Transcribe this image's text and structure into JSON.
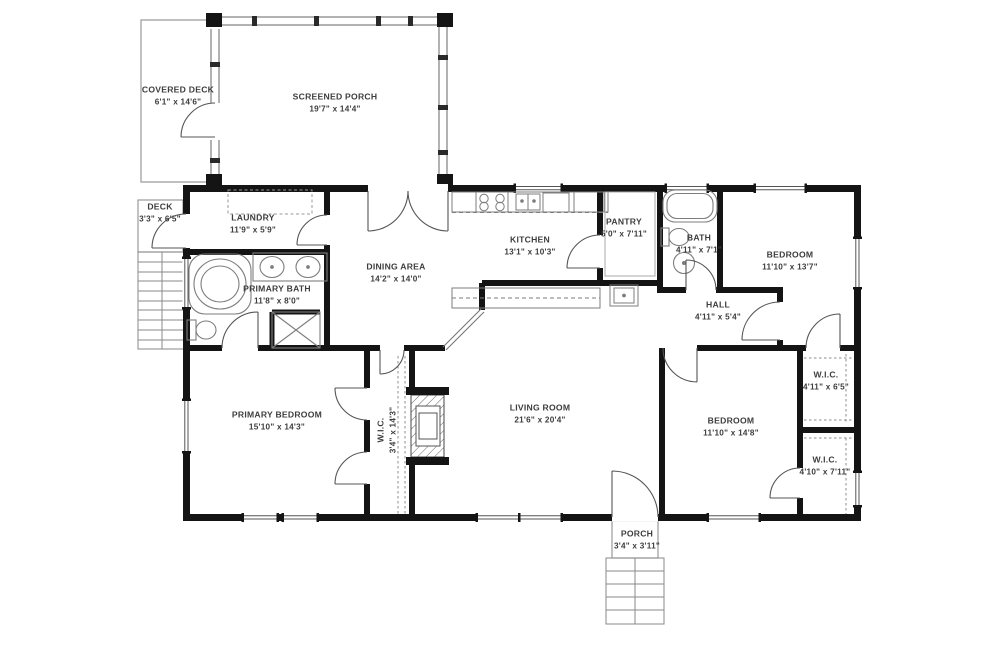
{
  "plan_type": "2D residential floor plan",
  "colors": {
    "walls": "#141414",
    "fixtures": "#777777",
    "labels": "#3d3d3d",
    "background": "#ffffff"
  },
  "rooms": [
    {
      "name": "COVERED DECK",
      "dims": "6'1\" x 14'6\""
    },
    {
      "name": "SCREENED PORCH",
      "dims": "19'7\" x 14'4\""
    },
    {
      "name": "DECK",
      "dims": "3'3\" x 6'5\""
    },
    {
      "name": "LAUNDRY",
      "dims": "11'9\" x 5'9\""
    },
    {
      "name": "PRIMARY BATH",
      "dims": "11'8\" x 8'0\""
    },
    {
      "name": "DINING AREA",
      "dims": "14'2\" x 14'0\""
    },
    {
      "name": "KITCHEN",
      "dims": "13'1\" x 10'3\""
    },
    {
      "name": "PANTRY",
      "dims": "5'0\" x 7'11\""
    },
    {
      "name": "BATH",
      "dims": "4'11\" x 7'1\""
    },
    {
      "name": "BEDROOM",
      "dims": "11'10\" x 13'7\""
    },
    {
      "name": "HALL",
      "dims": "4'11\" x 5'4\""
    },
    {
      "name": "PRIMARY BEDROOM",
      "dims": "15'10\" x 14'3\""
    },
    {
      "name": "W.I.C.",
      "dims": "3'4\" x 14'3\""
    },
    {
      "name": "LIVING ROOM",
      "dims": "21'6\" x 20'4\""
    },
    {
      "name": "BEDROOM",
      "dims": "11'10\" x 14'8\""
    },
    {
      "name": "W.I.C.",
      "dims": "4'11\" x 6'5\""
    },
    {
      "name": "W.I.C.",
      "dims": "4'10\" x 7'11\""
    },
    {
      "name": "PORCH",
      "dims": "3'4\" x 3'11\""
    }
  ],
  "fixtures": [
    "corner-tub",
    "double-vanity",
    "toilet",
    "shower",
    "bathtub",
    "round-sink",
    "stove",
    "kitchen-sink",
    "dishwasher",
    "refrigerator",
    "fireplace",
    "washer-dryer-area",
    "stairs",
    "closet-rods"
  ]
}
